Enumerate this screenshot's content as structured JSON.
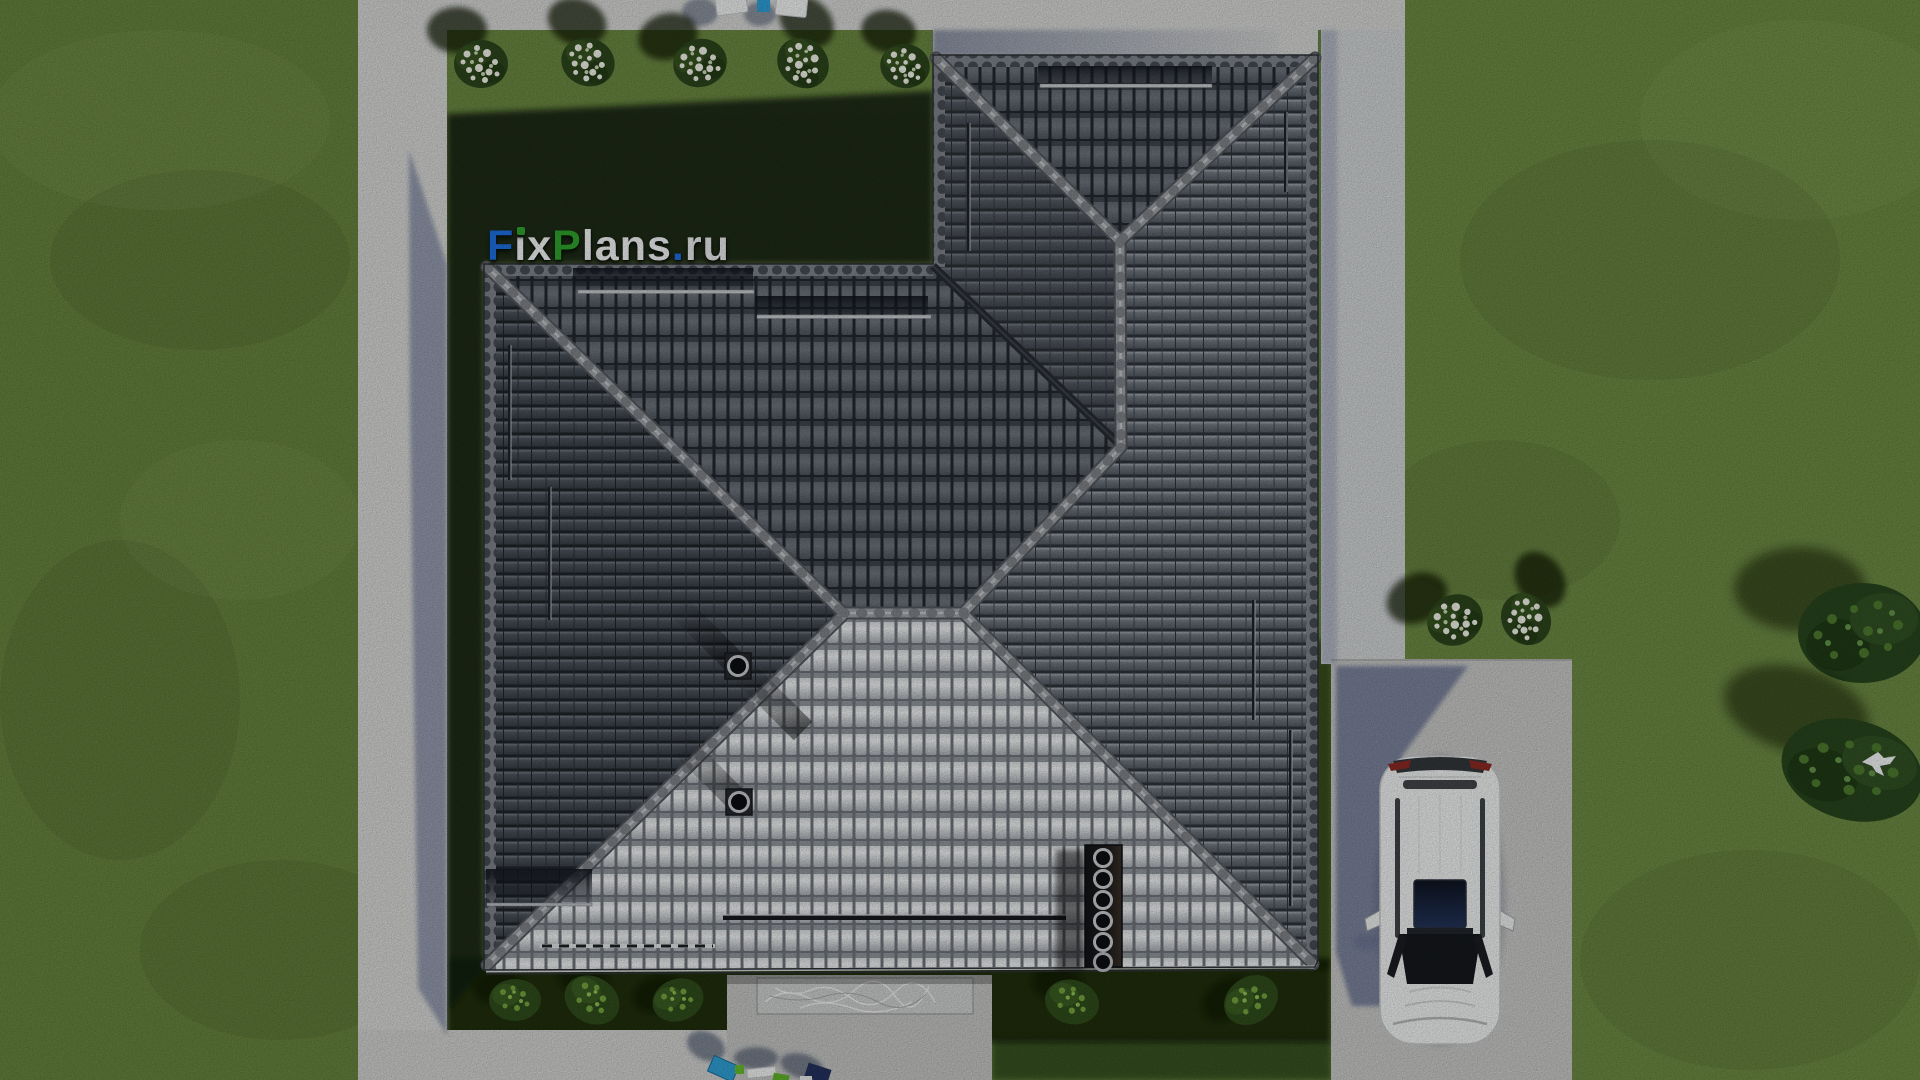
{
  "watermark": {
    "text": "FixPlans.ru",
    "segments": {
      "f": "F",
      "i_stem": "ı",
      "x": "x",
      "p": "P",
      "lans": "lans",
      "dot": ".",
      "ru": "ru"
    },
    "colors": {
      "blue": "#1d6fe2",
      "green": "#2fa32c",
      "white": "#f2f3f4"
    }
  },
  "scene": {
    "description": "Top-down 3D render of a house plan: complex hip roof, lawn, concrete walkways, driveway with parked white SUV",
    "palette": {
      "grass_lit": "#66823e",
      "grass_right": "#6f8d47",
      "grass_shadow": "#0e1b08",
      "concrete_lit": "#d5d6d4",
      "concrete_shadow": "#6b7494",
      "driveway": "#c6c7c5",
      "roof_tile_dark": "#22262c",
      "roof_column": "#6d737b",
      "roof_row_west": "#4a5058",
      "roof_row_east": "#6b727a",
      "roof_bright": "#eef0f1",
      "ridge_cap": "#9ea1a6",
      "valley": "#272b30",
      "car_body": "#eef0f0",
      "car_glass": "#15181c",
      "car_taillight": "#8c2a24",
      "flowers": "#eff1e7",
      "shrub": "#2f4c1c",
      "tree": "#28451d"
    },
    "objects": {
      "flower_bushes_top": 5,
      "flower_bushes_right": 2,
      "shrubs_bottom": 5,
      "tree_clusters_right": 2,
      "cars": 1,
      "roof_vents": 2,
      "chimney_flues": 6,
      "birds": 1
    }
  }
}
